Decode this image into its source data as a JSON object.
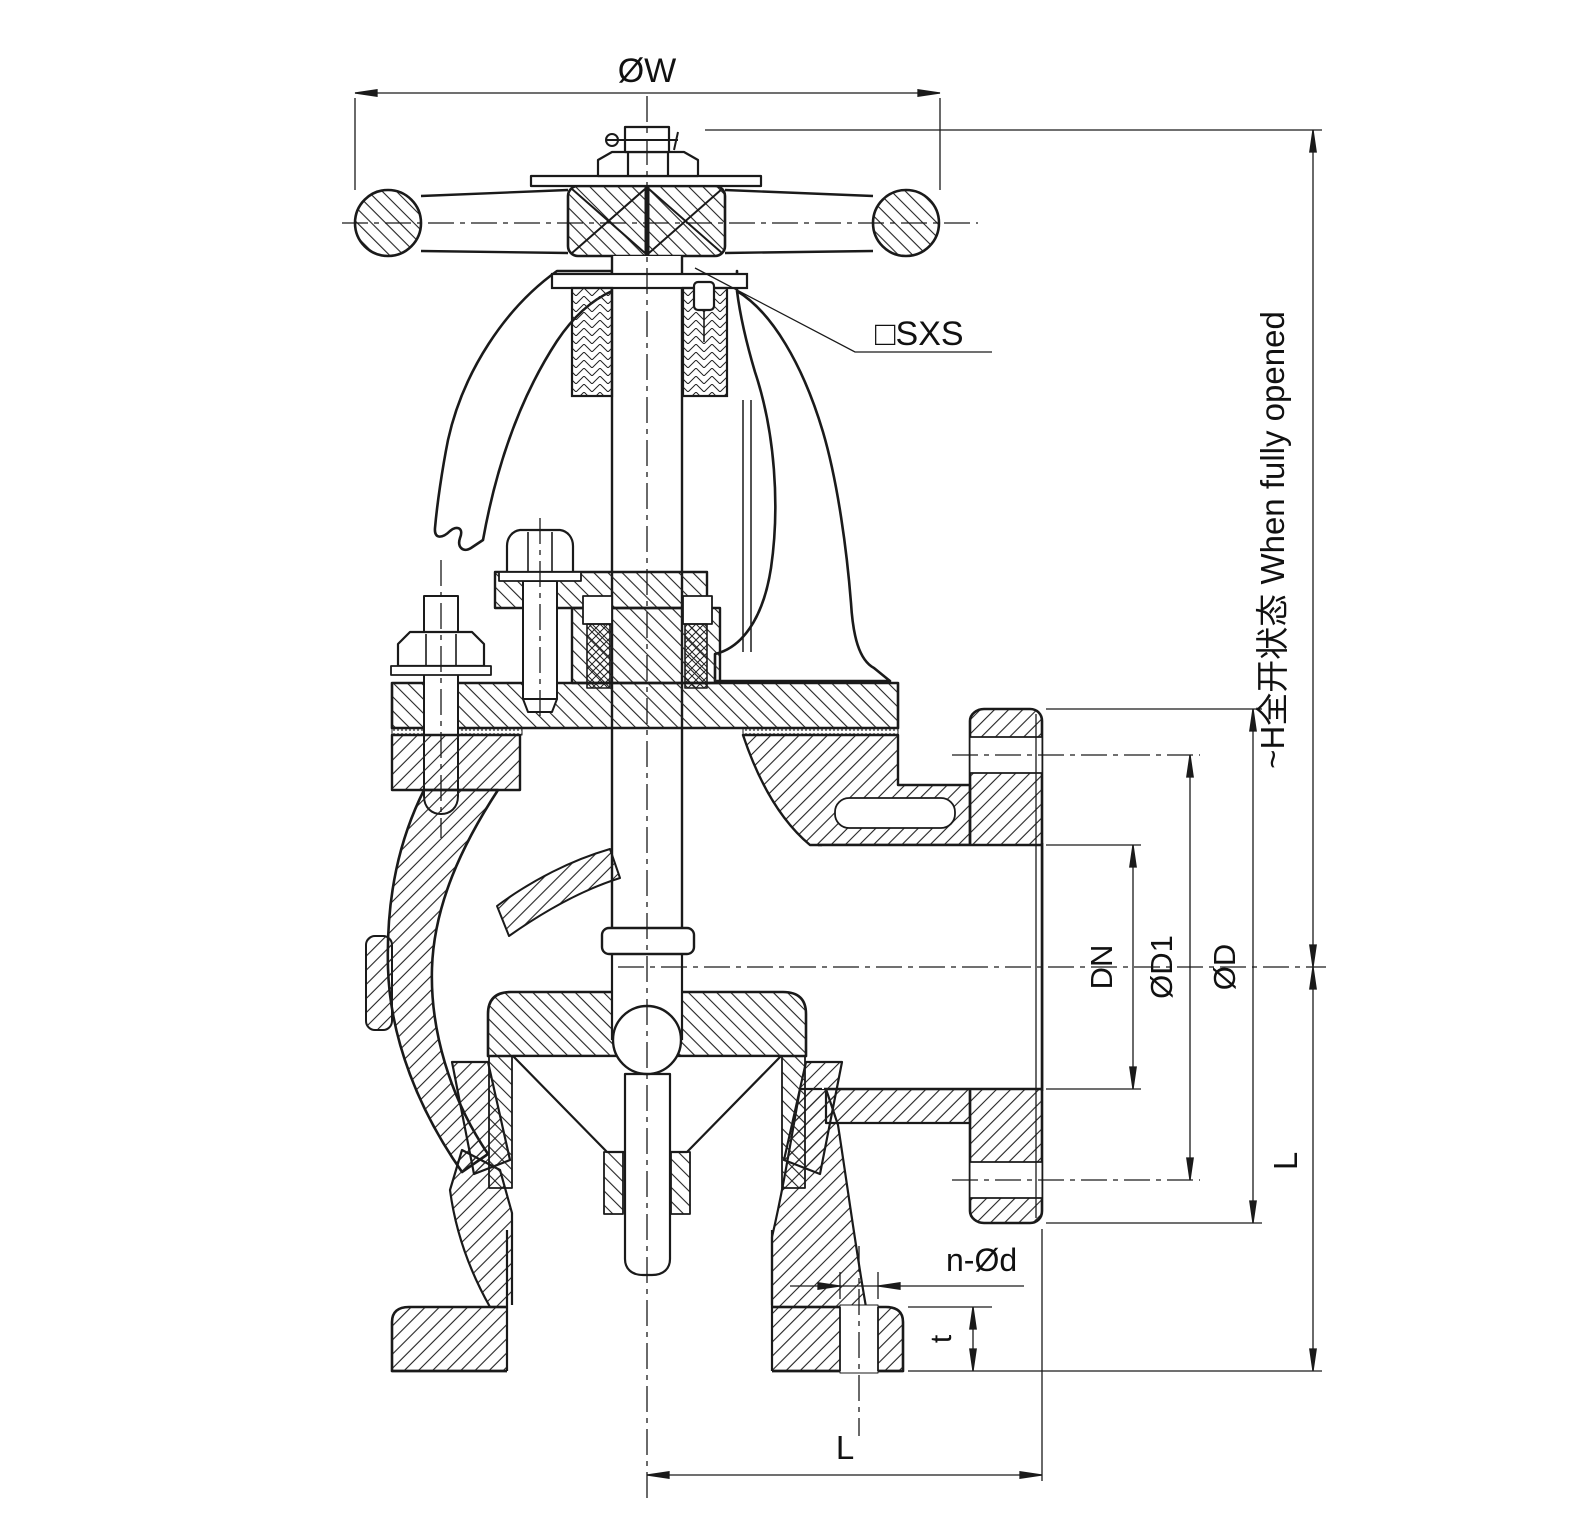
{
  "drawing": {
    "type": "engineering-section-drawing",
    "subject": "flanged angle globe valve, cross-section",
    "background": "#ffffff",
    "line_color": "#1a1a1a",
    "labels": {
      "handwheel_diameter": "ØW",
      "stem_square": "□SXS",
      "open_height": "~H全开状态  When fully opened",
      "nominal_bore": "DN",
      "bolt_circle_diameter": "ØD1",
      "flange_outer_diameter": "ØD",
      "center_to_face_side": "L",
      "bolt_holes": "n-Ød",
      "flange_thickness": "t",
      "center_to_face_bottom": "L"
    }
  }
}
